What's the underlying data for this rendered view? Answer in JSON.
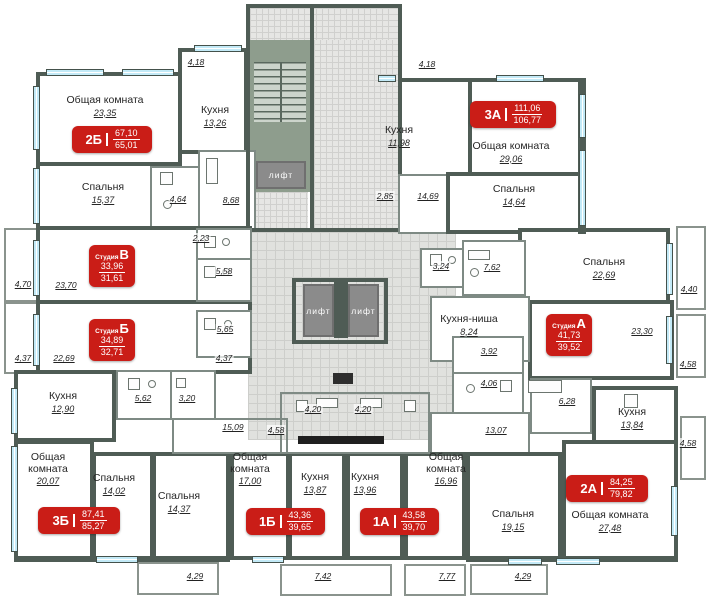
{
  "plan": {
    "colors": {
      "wall": "#4f5c55",
      "partition": "#7e8a84",
      "window": "#c3eaf7",
      "corridor": "#e0e1de",
      "stair_landing": "#8e9d8d",
      "elevator": "#8b8b8b",
      "badge_red": "#ca1d17",
      "text": "#262626"
    },
    "badges": [
      {
        "code": "2Б",
        "total": "67,10",
        "living": "65,01",
        "style": "wide",
        "x": 72,
        "y": 126,
        "w": 80,
        "h": 27
      },
      {
        "code": "3А",
        "total": "111,06",
        "living": "106,77",
        "style": "wide",
        "x": 470,
        "y": 101,
        "w": 86,
        "h": 27
      },
      {
        "code": "3Б",
        "total": "87,41",
        "living": "85,27",
        "style": "wide",
        "x": 38,
        "y": 507,
        "w": 82,
        "h": 27
      },
      {
        "code": "1Б",
        "total": "43,36",
        "living": "39,65",
        "style": "wide",
        "x": 246,
        "y": 508,
        "w": 79,
        "h": 27
      },
      {
        "code": "1А",
        "total": "43,58",
        "living": "39,70",
        "style": "wide",
        "x": 360,
        "y": 508,
        "w": 79,
        "h": 27
      },
      {
        "code": "2А",
        "total": "84,25",
        "living": "79,82",
        "style": "wide",
        "x": 566,
        "y": 475,
        "w": 82,
        "h": 27
      },
      {
        "code": "В",
        "prefix": "Студия",
        "total": "33,96",
        "living": "31,61",
        "style": "square",
        "x": 89,
        "y": 245,
        "w": 46,
        "h": 42
      },
      {
        "code": "Б",
        "prefix": "Студия",
        "total": "34,89",
        "living": "32,71",
        "style": "square",
        "x": 89,
        "y": 319,
        "w": 46,
        "h": 42
      },
      {
        "code": "А",
        "prefix": "Студия",
        "total": "41,73",
        "living": "39,52",
        "style": "square",
        "x": 546,
        "y": 314,
        "w": 46,
        "h": 42
      }
    ],
    "rooms": [
      {
        "name": "Общая комната",
        "area": "23,35",
        "x": 105,
        "y": 95
      },
      {
        "name": "Кухня",
        "area": "13,26",
        "x": 215,
        "y": 105
      },
      {
        "name": "Спальня",
        "area": "15,37",
        "x": 103,
        "y": 182
      },
      {
        "name": "Кухня",
        "area": "11,98",
        "x": 399,
        "y": 125
      },
      {
        "name": "Общая комната",
        "area": "29,06",
        "x": 511,
        "y": 141
      },
      {
        "name": "Спальня",
        "area": "14,64",
        "x": 514,
        "y": 184
      },
      {
        "name": "Спальня",
        "area": "22,69",
        "x": 604,
        "y": 257
      },
      {
        "name": "Кухня-ниша",
        "area": "8,24",
        "x": 469,
        "y": 314
      },
      {
        "name": "Кухня",
        "area": "12,90",
        "x": 63,
        "y": 391
      },
      {
        "name": "Кухня",
        "area": "13,84",
        "x": 632,
        "y": 407
      },
      {
        "name": "Общая комната",
        "area": "20,07",
        "x": 48,
        "y": 452,
        "stack": true
      },
      {
        "name": "Спальня",
        "area": "14,02",
        "x": 114,
        "y": 473
      },
      {
        "name": "Спальня",
        "area": "14,37",
        "x": 179,
        "y": 491
      },
      {
        "name": "Общая комната",
        "area": "17,00",
        "x": 250,
        "y": 452,
        "stack": true
      },
      {
        "name": "Кухня",
        "area": "13,87",
        "x": 315,
        "y": 472
      },
      {
        "name": "Кухня",
        "area": "13,96",
        "x": 365,
        "y": 472
      },
      {
        "name": "Общая комната",
        "area": "16,96",
        "x": 446,
        "y": 452,
        "stack": true
      },
      {
        "name": "Спальня",
        "area": "19,15",
        "x": 513,
        "y": 509
      },
      {
        "name": "Общая комната",
        "area": "27,48",
        "x": 610,
        "y": 510
      }
    ],
    "dims": [
      {
        "v": "4,18",
        "x": 196,
        "y": 62
      },
      {
        "v": "4,18",
        "x": 427,
        "y": 64
      },
      {
        "v": "4,64",
        "x": 178,
        "y": 199
      },
      {
        "v": "8,68",
        "x": 231,
        "y": 200
      },
      {
        "v": "2,23",
        "x": 201,
        "y": 238
      },
      {
        "v": "5,58",
        "x": 224,
        "y": 271
      },
      {
        "v": "5,65",
        "x": 225,
        "y": 329
      },
      {
        "v": "2,85",
        "x": 385,
        "y": 196
      },
      {
        "v": "14,69",
        "x": 428,
        "y": 196
      },
      {
        "v": "3,24",
        "x": 441,
        "y": 266
      },
      {
        "v": "7,62",
        "x": 492,
        "y": 267
      },
      {
        "v": "4,70",
        "x": 23,
        "y": 284
      },
      {
        "v": "23,70",
        "x": 66,
        "y": 285
      },
      {
        "v": "4,37",
        "x": 23,
        "y": 358
      },
      {
        "v": "22,69",
        "x": 64,
        "y": 358
      },
      {
        "v": "4,37",
        "x": 224,
        "y": 358
      },
      {
        "v": "4,40",
        "x": 689,
        "y": 289
      },
      {
        "v": "23,30",
        "x": 642,
        "y": 331
      },
      {
        "v": "4,58",
        "x": 688,
        "y": 364
      },
      {
        "v": "3,92",
        "x": 489,
        "y": 351
      },
      {
        "v": "4,06",
        "x": 489,
        "y": 383
      },
      {
        "v": "6,28",
        "x": 567,
        "y": 401
      },
      {
        "v": "13,07",
        "x": 496,
        "y": 430
      },
      {
        "v": "4,58",
        "x": 688,
        "y": 443
      },
      {
        "v": "5,62",
        "x": 143,
        "y": 398
      },
      {
        "v": "3,20",
        "x": 187,
        "y": 398
      },
      {
        "v": "15,09",
        "x": 233,
        "y": 427
      },
      {
        "v": "4,58",
        "x": 276,
        "y": 430
      },
      {
        "v": "4,20",
        "x": 313,
        "y": 409
      },
      {
        "v": "4,20",
        "x": 363,
        "y": 409
      },
      {
        "v": "4,29",
        "x": 195,
        "y": 576
      },
      {
        "v": "7,42",
        "x": 323,
        "y": 576
      },
      {
        "v": "7,77",
        "x": 447,
        "y": 576
      },
      {
        "v": "4,29",
        "x": 523,
        "y": 576
      }
    ],
    "elevators": [
      {
        "label": "лифт",
        "x": 256,
        "y": 161,
        "w": 50,
        "h": 28
      },
      {
        "label": "лифт",
        "x": 303,
        "y": 284,
        "w": 31,
        "h": 53
      },
      {
        "label": "лифт",
        "x": 348,
        "y": 284,
        "w": 31,
        "h": 53
      }
    ],
    "layout": {
      "fills": [
        {
          "cls": "corridor",
          "x": 248,
          "y": 232,
          "w": 208,
          "h": 208
        },
        {
          "cls": "bricks",
          "x": 314,
          "y": 8,
          "w": 84,
          "h": 222
        },
        {
          "cls": "bricks",
          "x": 250,
          "y": 8,
          "w": 144,
          "h": 32
        },
        {
          "cls": "landing",
          "x": 250,
          "y": 40,
          "w": 60,
          "h": 152
        },
        {
          "cls": "treads",
          "x": 254,
          "y": 62,
          "w": 52,
          "h": 60
        },
        {
          "cls": "bricks",
          "x": 252,
          "y": 192,
          "w": 56,
          "h": 38
        }
      ],
      "boxes": [
        {
          "x": 36,
          "y": 72,
          "w": 146,
          "h": 94
        },
        {
          "x": 36,
          "y": 162,
          "w": 118,
          "h": 68
        },
        {
          "x": 178,
          "y": 48,
          "w": 70,
          "h": 106
        },
        {
          "x": 150,
          "y": 166,
          "w": 52,
          "h": 64,
          "thin": true
        },
        {
          "x": 198,
          "y": 150,
          "w": 58,
          "h": 80,
          "thin": true
        },
        {
          "x": 246,
          "y": 4,
          "w": 68,
          "h": 228,
          "nobg": true
        },
        {
          "x": 310,
          "y": 4,
          "w": 92,
          "h": 228,
          "nobg": true
        },
        {
          "x": 398,
          "y": 78,
          "w": 74,
          "h": 100
        },
        {
          "x": 398,
          "y": 174,
          "w": 74,
          "h": 60,
          "thin": true
        },
        {
          "x": 468,
          "y": 78,
          "w": 118,
          "h": 98
        },
        {
          "x": 446,
          "y": 172,
          "w": 140,
          "h": 62
        },
        {
          "x": 518,
          "y": 228,
          "w": 152,
          "h": 76
        },
        {
          "x": 36,
          "y": 226,
          "w": 216,
          "h": 78
        },
        {
          "x": 36,
          "y": 300,
          "w": 216,
          "h": 74
        },
        {
          "x": 196,
          "y": 228,
          "w": 56,
          "h": 34,
          "thin": true
        },
        {
          "x": 196,
          "y": 258,
          "w": 56,
          "h": 44,
          "thin": true
        },
        {
          "x": 196,
          "y": 310,
          "w": 56,
          "h": 48,
          "thin": true
        },
        {
          "x": 420,
          "y": 248,
          "w": 48,
          "h": 40,
          "thin": true
        },
        {
          "x": 462,
          "y": 240,
          "w": 64,
          "h": 56,
          "thin": true
        },
        {
          "x": 14,
          "y": 370,
          "w": 102,
          "h": 72
        },
        {
          "x": 116,
          "y": 370,
          "w": 56,
          "h": 50,
          "thin": true
        },
        {
          "x": 170,
          "y": 370,
          "w": 46,
          "h": 50,
          "thin": true
        },
        {
          "x": 528,
          "y": 300,
          "w": 146,
          "h": 80
        },
        {
          "x": 430,
          "y": 296,
          "w": 100,
          "h": 66,
          "thin": true
        },
        {
          "x": 452,
          "y": 336,
          "w": 72,
          "h": 40,
          "thin": true
        },
        {
          "x": 452,
          "y": 372,
          "w": 72,
          "h": 44,
          "thin": true
        },
        {
          "x": 530,
          "y": 378,
          "w": 62,
          "h": 56,
          "thin": true
        },
        {
          "x": 592,
          "y": 386,
          "w": 86,
          "h": 64
        },
        {
          "x": 430,
          "y": 412,
          "w": 100,
          "h": 48,
          "thin": true
        },
        {
          "x": 14,
          "y": 440,
          "w": 80,
          "h": 120
        },
        {
          "x": 92,
          "y": 452,
          "w": 62,
          "h": 108
        },
        {
          "x": 152,
          "y": 452,
          "w": 78,
          "h": 108
        },
        {
          "x": 230,
          "y": 452,
          "w": 60,
          "h": 108
        },
        {
          "x": 288,
          "y": 452,
          "w": 58,
          "h": 108
        },
        {
          "x": 346,
          "y": 452,
          "w": 58,
          "h": 108
        },
        {
          "x": 404,
          "y": 452,
          "w": 62,
          "h": 108
        },
        {
          "x": 466,
          "y": 452,
          "w": 96,
          "h": 110
        },
        {
          "x": 562,
          "y": 440,
          "w": 116,
          "h": 122
        },
        {
          "x": 280,
          "y": 392,
          "w": 150,
          "h": 62,
          "thin": true,
          "nobg": true
        },
        {
          "x": 172,
          "y": 418,
          "w": 116,
          "h": 36,
          "thin": true,
          "nobg": true
        },
        {
          "x": 292,
          "y": 278,
          "w": 96,
          "h": 66,
          "nobg": true
        }
      ],
      "balconies": [
        {
          "x": 4,
          "y": 228,
          "w": 34,
          "h": 74
        },
        {
          "x": 4,
          "y": 302,
          "w": 34,
          "h": 72
        },
        {
          "x": 676,
          "y": 226,
          "w": 30,
          "h": 84
        },
        {
          "x": 676,
          "y": 314,
          "w": 30,
          "h": 64
        },
        {
          "x": 680,
          "y": 416,
          "w": 26,
          "h": 64
        },
        {
          "x": 137,
          "y": 562,
          "w": 82,
          "h": 33
        },
        {
          "x": 280,
          "y": 564,
          "w": 112,
          "h": 32
        },
        {
          "x": 404,
          "y": 564,
          "w": 62,
          "h": 32
        },
        {
          "x": 470,
          "y": 564,
          "w": 78,
          "h": 31
        }
      ],
      "wallsegs": [
        {
          "x": 14,
          "y": 556,
          "w": 216,
          "h": 6
        },
        {
          "x": 466,
          "y": 556,
          "w": 212,
          "h": 6
        },
        {
          "x": 578,
          "y": 78,
          "w": 8,
          "h": 156
        },
        {
          "x": 334,
          "y": 282,
          "w": 14,
          "h": 56
        },
        {
          "x": 298,
          "y": 436,
          "w": 86,
          "h": 8,
          "c": "#1f1f1f"
        },
        {
          "x": 333,
          "y": 373,
          "w": 20,
          "h": 11,
          "c": "#2e2e2e"
        }
      ],
      "windows": [
        {
          "x": 46,
          "y": 69,
          "w": 58,
          "h": 7
        },
        {
          "x": 122,
          "y": 69,
          "w": 52,
          "h": 7
        },
        {
          "x": 194,
          "y": 45,
          "w": 48,
          "h": 7
        },
        {
          "x": 378,
          "y": 75,
          "w": 18,
          "h": 7
        },
        {
          "x": 496,
          "y": 75,
          "w": 48,
          "h": 7
        },
        {
          "x": 96,
          "y": 556,
          "w": 42,
          "h": 7
        },
        {
          "x": 252,
          "y": 556,
          "w": 32,
          "h": 7
        },
        {
          "x": 508,
          "y": 558,
          "w": 34,
          "h": 7
        },
        {
          "x": 556,
          "y": 558,
          "w": 44,
          "h": 7
        },
        {
          "x": 33,
          "y": 86,
          "w": 7,
          "h": 64,
          "v": true
        },
        {
          "x": 33,
          "y": 168,
          "w": 7,
          "h": 56,
          "v": true
        },
        {
          "x": 33,
          "y": 240,
          "w": 7,
          "h": 56,
          "v": true
        },
        {
          "x": 33,
          "y": 314,
          "w": 7,
          "h": 52,
          "v": true
        },
        {
          "x": 11,
          "y": 388,
          "w": 7,
          "h": 46,
          "v": true
        },
        {
          "x": 11,
          "y": 446,
          "w": 7,
          "h": 106,
          "v": true
        },
        {
          "x": 579,
          "y": 94,
          "w": 7,
          "h": 44,
          "v": true
        },
        {
          "x": 579,
          "y": 150,
          "w": 7,
          "h": 76,
          "v": true
        },
        {
          "x": 666,
          "y": 243,
          "w": 7,
          "h": 52,
          "v": true
        },
        {
          "x": 666,
          "y": 316,
          "w": 7,
          "h": 48,
          "v": true
        },
        {
          "x": 671,
          "y": 486,
          "w": 7,
          "h": 50,
          "v": true
        }
      ],
      "fixtures": [
        {
          "t": "rect",
          "x": 160,
          "y": 172,
          "w": 13,
          "h": 13
        },
        {
          "t": "circ",
          "x": 163,
          "y": 200,
          "w": 9,
          "h": 9
        },
        {
          "t": "rect",
          "x": 206,
          "y": 158,
          "w": 12,
          "h": 26
        },
        {
          "t": "rect",
          "x": 204,
          "y": 236,
          "w": 12,
          "h": 12
        },
        {
          "t": "circ",
          "x": 222,
          "y": 238,
          "w": 8,
          "h": 8
        },
        {
          "t": "rect",
          "x": 204,
          "y": 266,
          "w": 12,
          "h": 12
        },
        {
          "t": "circ",
          "x": 222,
          "y": 268,
          "w": 8,
          "h": 8
        },
        {
          "t": "rect",
          "x": 204,
          "y": 318,
          "w": 12,
          "h": 12
        },
        {
          "t": "circ",
          "x": 224,
          "y": 320,
          "w": 8,
          "h": 8
        },
        {
          "t": "rect",
          "x": 128,
          "y": 378,
          "w": 12,
          "h": 12
        },
        {
          "t": "circ",
          "x": 148,
          "y": 380,
          "w": 8,
          "h": 8
        },
        {
          "t": "rect",
          "x": 176,
          "y": 378,
          "w": 10,
          "h": 10
        },
        {
          "t": "rect",
          "x": 430,
          "y": 254,
          "w": 12,
          "h": 12
        },
        {
          "t": "circ",
          "x": 448,
          "y": 256,
          "w": 8,
          "h": 8
        },
        {
          "t": "rect",
          "x": 468,
          "y": 250,
          "w": 22,
          "h": 10
        },
        {
          "t": "circ",
          "x": 470,
          "y": 268,
          "w": 9,
          "h": 9
        },
        {
          "t": "rect",
          "x": 528,
          "y": 380,
          "w": 34,
          "h": 13
        },
        {
          "t": "circ",
          "x": 466,
          "y": 384,
          "w": 9,
          "h": 9
        },
        {
          "t": "rect",
          "x": 500,
          "y": 380,
          "w": 12,
          "h": 12
        },
        {
          "t": "rect",
          "x": 296,
          "y": 400,
          "w": 12,
          "h": 12
        },
        {
          "t": "rect",
          "x": 316,
          "y": 398,
          "w": 22,
          "h": 10
        },
        {
          "t": "rect",
          "x": 360,
          "y": 398,
          "w": 22,
          "h": 10
        },
        {
          "t": "rect",
          "x": 404,
          "y": 400,
          "w": 12,
          "h": 12
        },
        {
          "t": "rect",
          "x": 624,
          "y": 394,
          "w": 14,
          "h": 14
        }
      ]
    }
  }
}
